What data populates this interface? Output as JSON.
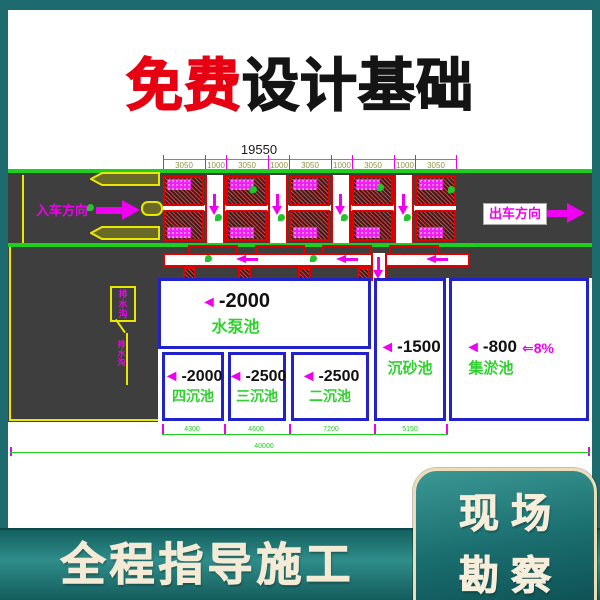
{
  "title": {
    "free": "免费",
    "rest": "设计基础"
  },
  "drawing": {
    "marker": "◄",
    "dims_top": {
      "total": "19550",
      "segments": [
        "3050",
        "1000",
        "3050",
        "1000",
        "3050",
        "1000",
        "3050",
        "1000",
        "3050"
      ]
    },
    "road": {
      "entry": "入车方向",
      "exit": "出车方向"
    },
    "note": {
      "box": "排水沟",
      "leader": "排水沟"
    },
    "tanks": {
      "pump": {
        "depth": "-2000",
        "name": "水泵池"
      },
      "t4": {
        "depth": "-2000",
        "name": "四沉池"
      },
      "t3": {
        "depth": "-2500",
        "name": "三沉池"
      },
      "t2": {
        "depth": "-2500",
        "name": "二沉池"
      },
      "sand": {
        "depth": "-1500",
        "name": "沉砂池"
      },
      "silt": {
        "depth": "-800",
        "name": "集淤池"
      }
    },
    "slope": "⇐8%",
    "dims_bottom": {
      "segments": [
        "4300",
        "4600",
        "7200",
        "5150"
      ],
      "total": "40000"
    }
  },
  "footer": {
    "left_text": "全程指导施工",
    "right_line1": "现场",
    "right_line2": "勘察"
  },
  "colors": {
    "teal_background": "#1d6b6e",
    "cream_text": "#f4ebd7",
    "title_red": "#e60012",
    "cad_green": "#1ecf1e",
    "cad_magenta": "#f000f0",
    "cad_blue_wall": "#2222cc",
    "cad_red": "#e00000",
    "cad_yellow": "#e8e800",
    "road_gray": "#3e3e3e"
  }
}
